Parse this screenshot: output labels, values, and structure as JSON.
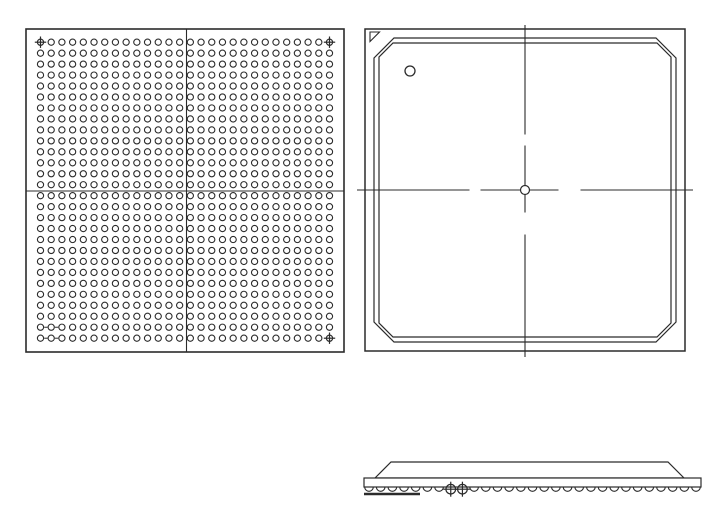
{
  "drawing": {
    "kind": "bga-package-outline-drawing",
    "colors": {
      "background": "#ffffff",
      "line": "#2b2b2b"
    },
    "bottom_view": {
      "name": "ball-grid-bottom-view",
      "frame": {
        "x": 26,
        "y": 29,
        "width": 318,
        "height": 323
      },
      "grid": {
        "columns": 28,
        "rows": 28
      },
      "ball_radius": 3.1,
      "first_ball": {
        "x": 40.5,
        "y": 42.2
      },
      "fiducial_cells": [
        [
          0,
          0
        ],
        [
          27,
          0
        ],
        [
          27,
          27
        ]
      ],
      "quadrant_lines": {
        "vertical_x": 186.5,
        "horizontal_y": 191
      },
      "pitch_tick_rows": [
        26,
        27
      ],
      "pitch_tick_columns": [
        0,
        1
      ]
    },
    "top_view": {
      "name": "package-top-view",
      "frame": {
        "x": 365,
        "y": 29,
        "width": 320,
        "height": 322
      },
      "lid": {
        "insets": [
          9,
          14
        ],
        "chamfers": [
          20,
          14
        ]
      },
      "pin1_triangle": {
        "x": 370,
        "y": 32,
        "size": 9.5
      },
      "pin1_circle": {
        "cx": 410,
        "cy": 71,
        "r": 5
      },
      "center_mark": {
        "cx": 525,
        "cy": 190,
        "r": 4.5
      },
      "centerline_overhang": 8,
      "centerline_gap": 11,
      "centerline_dash": 29
    },
    "side_view": {
      "name": "package-side-view",
      "substrate": {
        "x": 364,
        "y": 478,
        "width": 337,
        "height": 9
      },
      "lid": {
        "base_x1": 375,
        "base_x2": 684,
        "top_x1": 391,
        "top_x2": 668,
        "top_y": 462
      },
      "balls": {
        "count": 29,
        "x_start": 369,
        "x_end": 696,
        "radius": 4.3
      },
      "fiducial_ball_indices": [
        7,
        8
      ],
      "datum_line": {
        "x1": 364,
        "x2": 420,
        "y": 494
      }
    }
  }
}
